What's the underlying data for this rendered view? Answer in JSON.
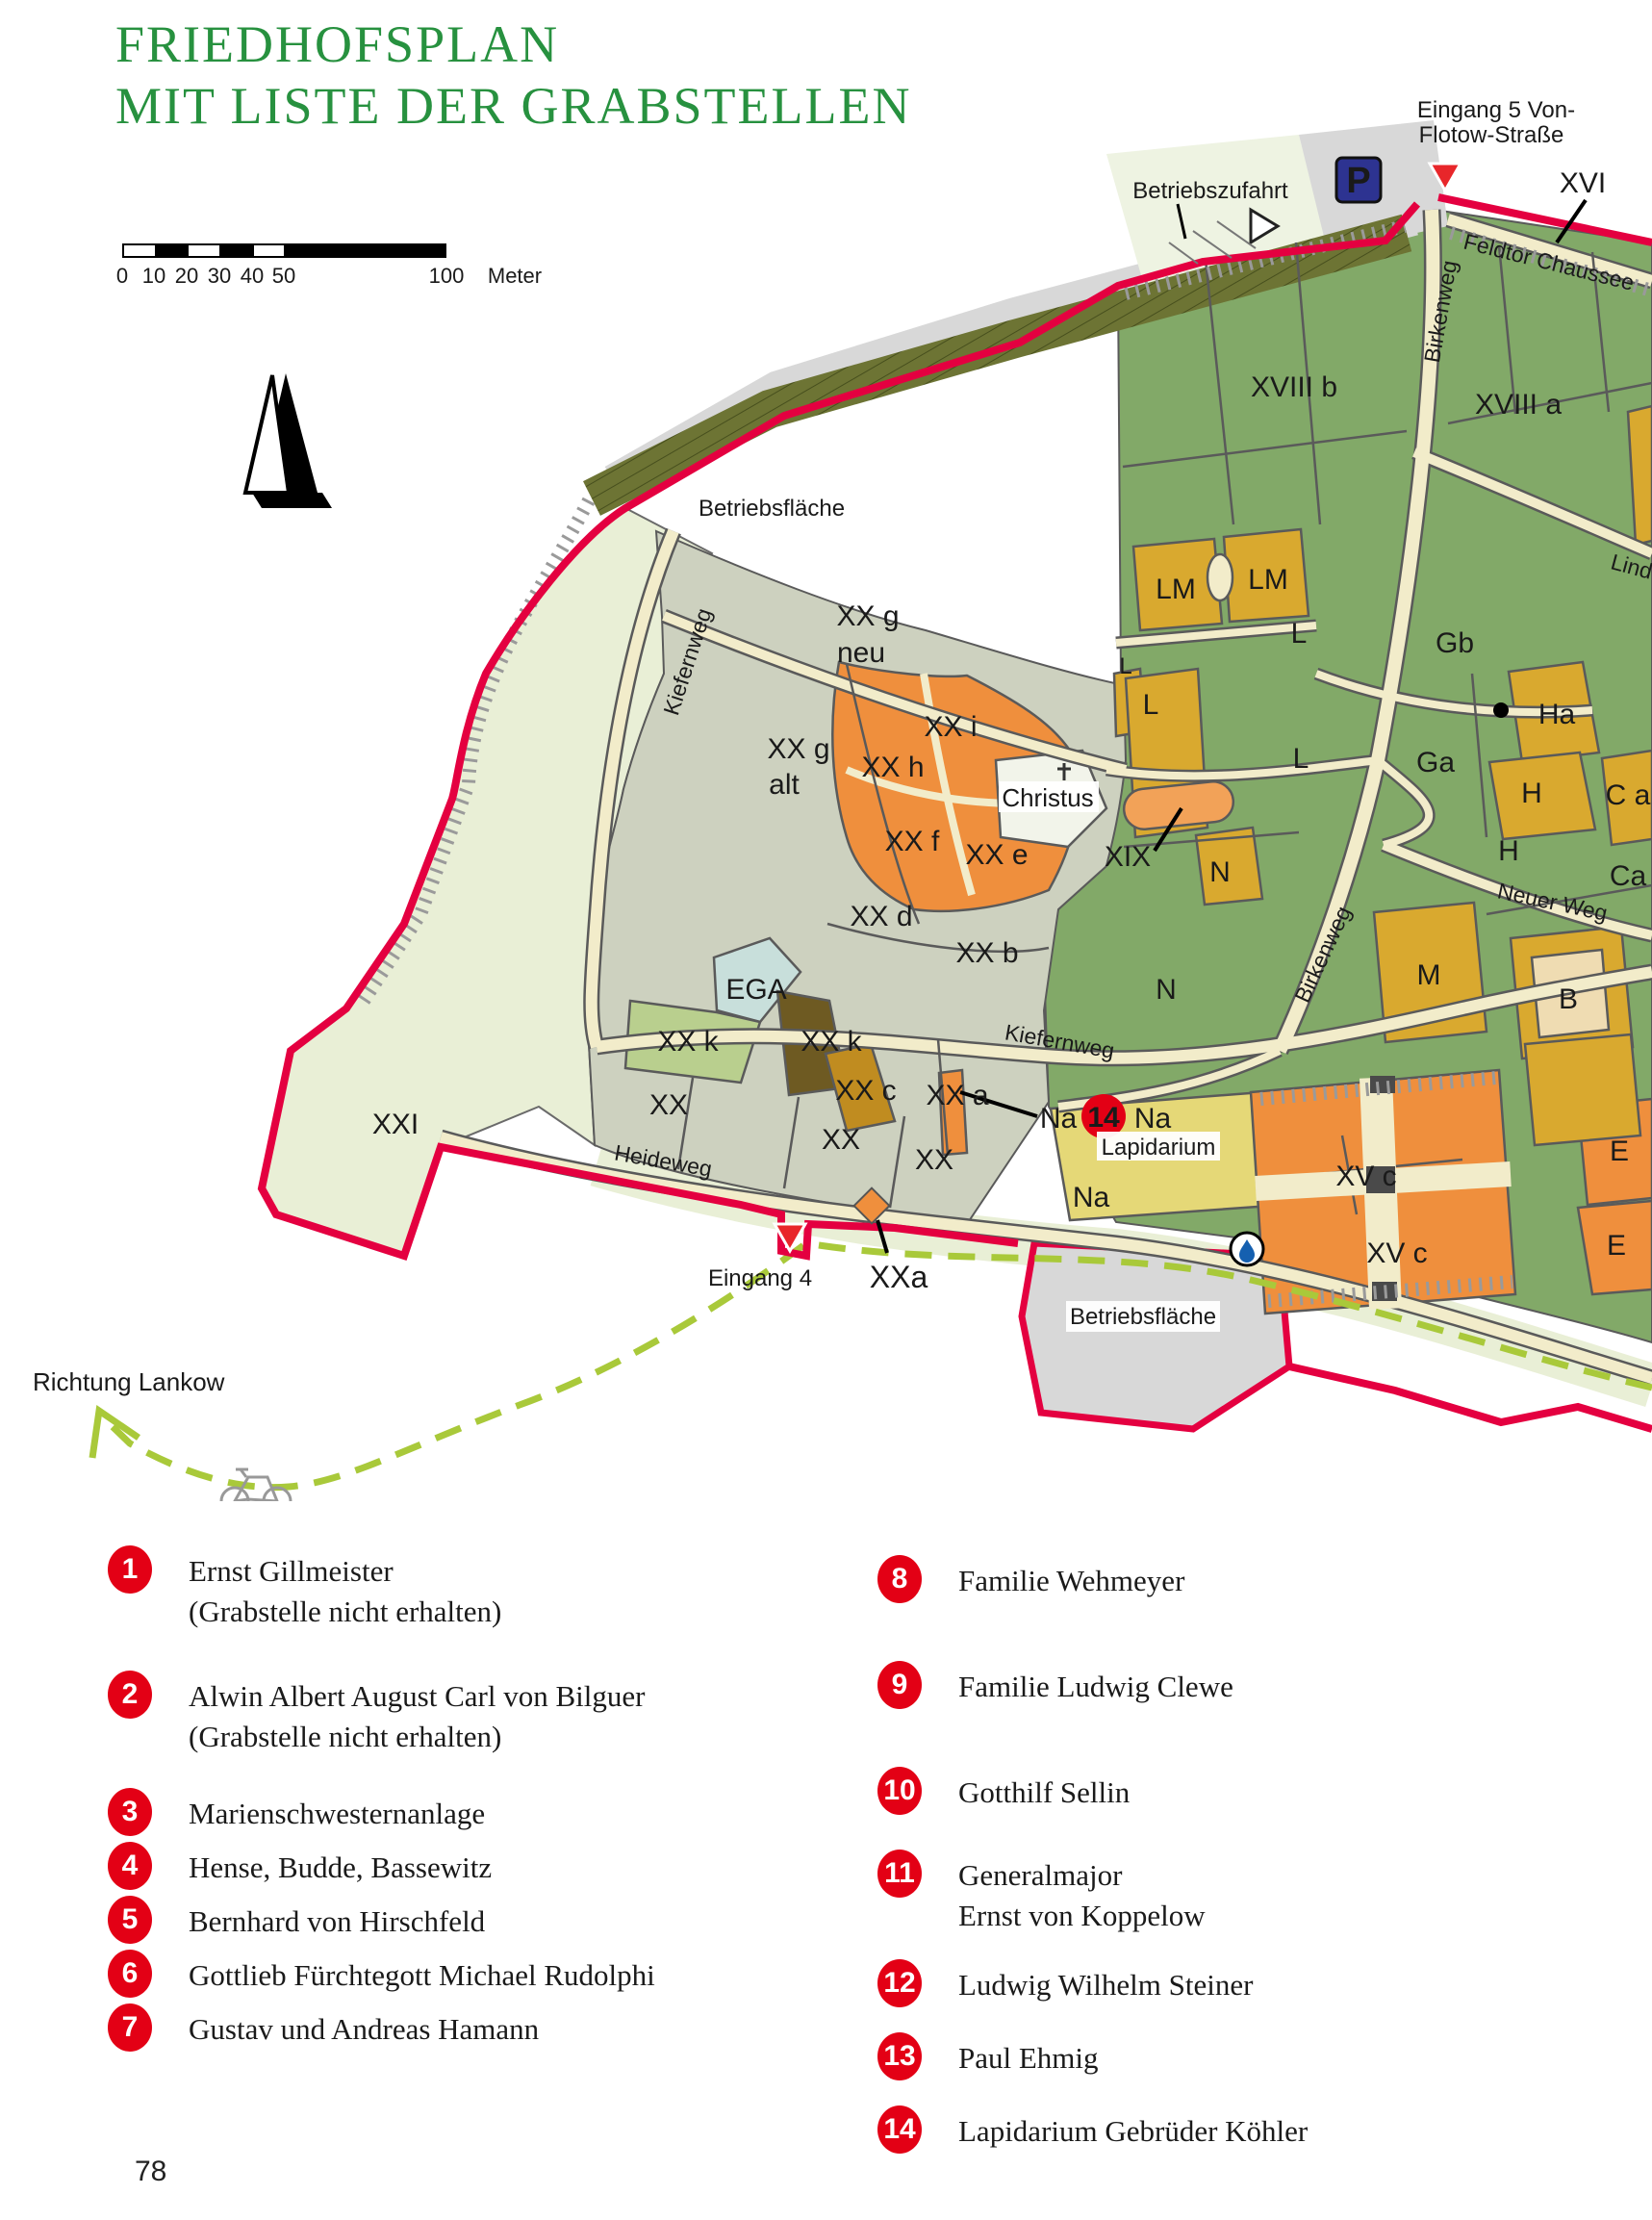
{
  "page": {
    "title_line1": "FRIEDHOFSPLAN",
    "title_line2": "MIT LISTE DER GRABSTELLEN",
    "page_number": "78"
  },
  "colors": {
    "title_green": "#27913f",
    "boundary_red": "#e40040",
    "badge_red": "#e30015",
    "bike_path_green": "#a9c93a",
    "parking_blue": "#2d3391",
    "section_green": "#82a968",
    "section_gold": "#d9a92f",
    "section_orange": "#ef8f3d",
    "section_graygreen": "#cdd1bf",
    "road_cream": "#f2ecca"
  },
  "scalebar": {
    "ticks": [
      "0",
      "10",
      "20",
      "30",
      "40",
      "50"
    ],
    "end_label": "100",
    "unit": "Meter"
  },
  "map": {
    "labels": {
      "eingang5_1": "Eingang 5 Von-",
      "eingang5_2": "Flotow-Straße",
      "betriebszufahrt": "Betriebszufahrt",
      "xvi": "XVI",
      "feldtor": "Feldtor Chaussee",
      "birkenweg1": "Birkenweg",
      "birkenweg2": "Birkenweg",
      "xviii_b": "XVIII b",
      "xviii_a": "XVIII a",
      "linde": "Linde",
      "lm1": "LM",
      "lm2": "LM",
      "l1": "L",
      "gb": "Gb",
      "l2": "L",
      "l3": "L",
      "l4": "L",
      "ga": "Ga",
      "ha": "Ha",
      "h1": "H",
      "c_a": "C a",
      "h2": "H",
      "ca": "Ca",
      "neuer_weg": "Neuer Weg",
      "xix": "XIX",
      "n1": "N",
      "xxg_neu_1": "XX g",
      "xxg_neu_2": "neu",
      "xxg_alt_1": "XX g",
      "xxg_alt_2": "alt",
      "xx_i": "XX i",
      "xx_h": "XX h",
      "xx_f": "XX f",
      "xx_e": "XX e",
      "christus": "Christus",
      "xx_d": "XX d",
      "xx_b": "XX b",
      "kiefernweg1": "Kiefernweg",
      "kiefernweg2": "Kiefernweg",
      "ega": "EGA",
      "xx_k1": "XX k",
      "xx_k2": "XX k",
      "xx_c": "XX c",
      "xx_a": "XX a",
      "xx1": "XX",
      "xx2": "XX",
      "xx3": "XX",
      "n2": "N",
      "m": "M",
      "b": "B",
      "na1": "Na",
      "na2": "Na",
      "na3": "Na",
      "lapidarium": "Lapidarium",
      "marker14": "14",
      "heideweg": "Heideweg",
      "xxi": "XXI",
      "eingang4": "Eingang 4",
      "xxa": "XXa",
      "xvc1": "XV c",
      "xvc2": "XV c",
      "e1": "E",
      "e2": "E",
      "betriebsflaeche_top": "Betriebsfläche",
      "betriebsflaeche_bottom": "Betriebsfläche",
      "richtung_lankow": "Richtung Lankow",
      "parking": "P"
    }
  },
  "legend": {
    "items": [
      {
        "num": "1",
        "line1": "Ernst Gillmeister",
        "line2": "(Grabstelle nicht erhalten)"
      },
      {
        "num": "2",
        "line1": "Alwin Albert August Carl von Bilguer",
        "line2": "(Grabstelle nicht erhalten)"
      },
      {
        "num": "3",
        "line1": "Marienschwesternanlage"
      },
      {
        "num": "4",
        "line1": "Hense, Budde, Bassewitz"
      },
      {
        "num": "5",
        "line1": "Bernhard von Hirschfeld"
      },
      {
        "num": "6",
        "line1": "Gottlieb Fürchtegott Michael Rudolphi"
      },
      {
        "num": "7",
        "line1": "Gustav und Andreas Hamann"
      },
      {
        "num": "8",
        "line1": "Familie Wehmeyer"
      },
      {
        "num": "9",
        "line1": "Familie Ludwig Clewe"
      },
      {
        "num": "10",
        "line1": "Gotthilf Sellin"
      },
      {
        "num": "11",
        "line1": "Generalmajor",
        "line2": "Ernst von Koppelow"
      },
      {
        "num": "12",
        "line1": "Ludwig Wilhelm Steiner"
      },
      {
        "num": "13",
        "line1": "Paul Ehmig"
      },
      {
        "num": "14",
        "line1": "Lapidarium Gebrüder Köhler"
      }
    ]
  }
}
